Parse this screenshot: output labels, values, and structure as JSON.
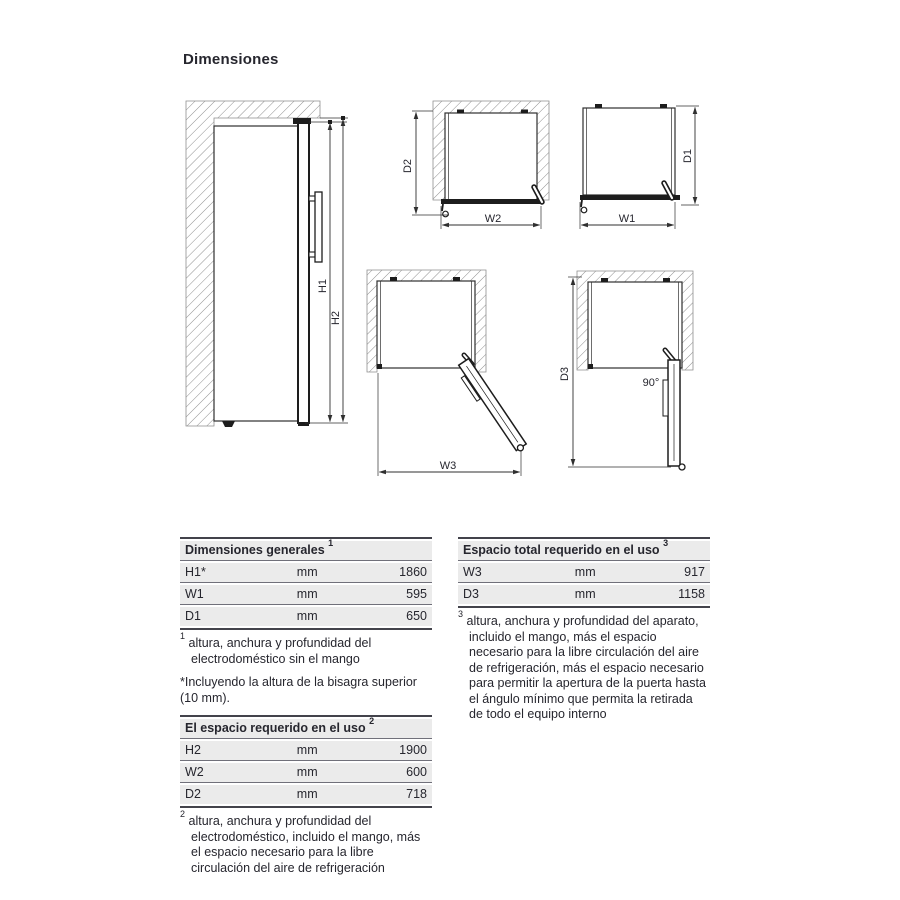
{
  "page": {
    "title": "Dimensiones"
  },
  "colors": {
    "text": "#26262e",
    "row_bg": "#ebebeb",
    "table_border": "#43434b",
    "drawing_line": "#2f2f2f"
  },
  "diagrams": {
    "side": {
      "h1": "H1",
      "h2": "H2"
    },
    "top_w2": {
      "d2": "D2",
      "w2": "W2"
    },
    "top_w1": {
      "d1": "D1",
      "w1": "W1"
    },
    "open_w3": {
      "w3": "W3"
    },
    "open_90": {
      "d3": "D3",
      "angle": "90°"
    }
  },
  "tables": {
    "general": {
      "title": "Dimensiones generales",
      "sup": "1",
      "rows": [
        {
          "label": "H1*",
          "unit": "mm",
          "value": "1860"
        },
        {
          "label": "W1",
          "unit": "mm",
          "value": "595"
        },
        {
          "label": "D1",
          "unit": "mm",
          "value": "650"
        }
      ],
      "footnotes": [
        {
          "marker": "1",
          "text": "altura, anchura y profundidad del electrodoméstico sin el mango"
        },
        {
          "marker": "*",
          "text": "Incluyendo la altura de la bisagra superior (10 mm)."
        }
      ]
    },
    "in_use": {
      "title": "El espacio requerido en el uso",
      "sup": "2",
      "rows": [
        {
          "label": "H2",
          "unit": "mm",
          "value": "1900"
        },
        {
          "label": "W2",
          "unit": "mm",
          "value": "600"
        },
        {
          "label": "D2",
          "unit": "mm",
          "value": "718"
        }
      ],
      "footnotes": [
        {
          "marker": "2",
          "text": "altura, anchura y profundidad del electrodoméstico, incluido el mango, más el espacio necesario para la libre circulación del aire de refrigeración"
        }
      ]
    },
    "total": {
      "title": "Espacio total requerido en el uso",
      "sup": "3",
      "rows": [
        {
          "label": "W3",
          "unit": "mm",
          "value": "917"
        },
        {
          "label": "D3",
          "unit": "mm",
          "value": "1158"
        }
      ],
      "footnotes": [
        {
          "marker": "3",
          "text": "altura, anchura y profundidad del aparato, incluido el mango, más el espacio necesario para la libre circulación del aire de refrigeración, más el espacio necesario para permitir la apertura de la puerta hasta el ángulo mínimo que permita la retirada de todo el equipo interno"
        }
      ]
    }
  }
}
